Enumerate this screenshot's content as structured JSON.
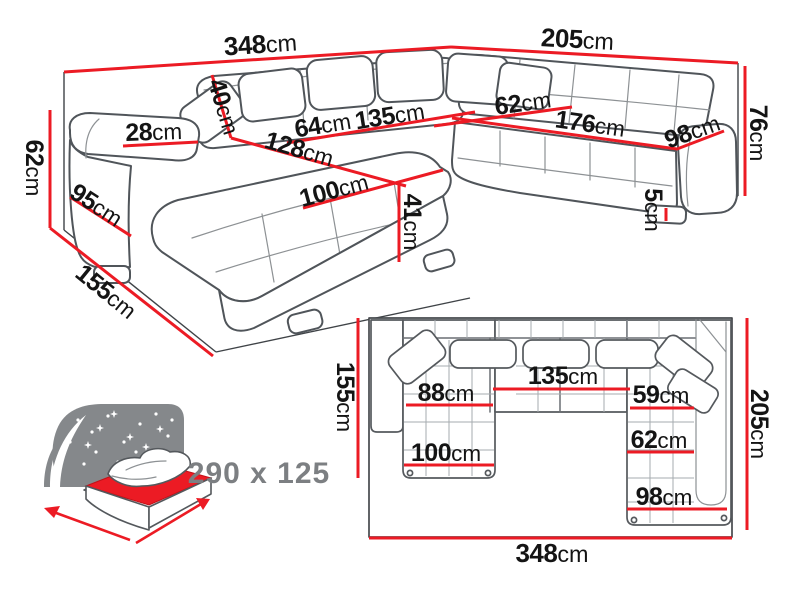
{
  "colors": {
    "accent": "#ec1b24",
    "outline": "#50555a",
    "text": "#141414",
    "muted_text": "#7c7f82"
  },
  "perspective_view": {
    "description": "corner sofa 3D dimension drawing",
    "dims": {
      "w_back_left": {
        "value": "348",
        "unit": "cm"
      },
      "w_back_right": {
        "value": "205",
        "unit": "cm"
      },
      "h_right": {
        "value": "76",
        "unit": "cm"
      },
      "h_left": {
        "value": "62",
        "unit": "cm"
      },
      "d_left": {
        "value": "155",
        "unit": "cm"
      },
      "armrest_side": {
        "value": "95",
        "unit": "cm"
      },
      "armrest_top": {
        "value": "28",
        "unit": "cm"
      },
      "back_cushion": {
        "value": "40",
        "unit": "cm"
      },
      "seat_back_w1": {
        "value": "64",
        "unit": "cm"
      },
      "seat_back_w2": {
        "value": "135",
        "unit": "cm"
      },
      "corner_w": {
        "value": "62",
        "unit": "cm"
      },
      "seat_front": {
        "value": "128",
        "unit": "cm"
      },
      "right_seat_len": {
        "value": "176",
        "unit": "cm"
      },
      "right_end_w": {
        "value": "98",
        "unit": "cm"
      },
      "chaise_len": {
        "value": "100",
        "unit": "cm"
      },
      "seat_h": {
        "value": "41",
        "unit": "cm"
      },
      "leg_h": {
        "value": "5",
        "unit": "cm"
      }
    }
  },
  "plan_view": {
    "description": "corner sofa top-down dimension drawing",
    "dims": {
      "depth_left": {
        "value": "155",
        "unit": "cm"
      },
      "depth_right": {
        "value": "205",
        "unit": "cm"
      },
      "total_width": {
        "value": "348",
        "unit": "cm"
      },
      "mid_width": {
        "value": "135",
        "unit": "cm"
      },
      "chaise_top": {
        "value": "88",
        "unit": "cm"
      },
      "right_top": {
        "value": "59",
        "unit": "cm"
      },
      "chaise_w": {
        "value": "100",
        "unit": "cm"
      },
      "right_mid": {
        "value": "62",
        "unit": "cm"
      },
      "right_bottom": {
        "value": "98",
        "unit": "cm"
      }
    }
  },
  "sleeping_area": {
    "label": "290 x 125",
    "icon": "sofa-bed-night-icon"
  }
}
